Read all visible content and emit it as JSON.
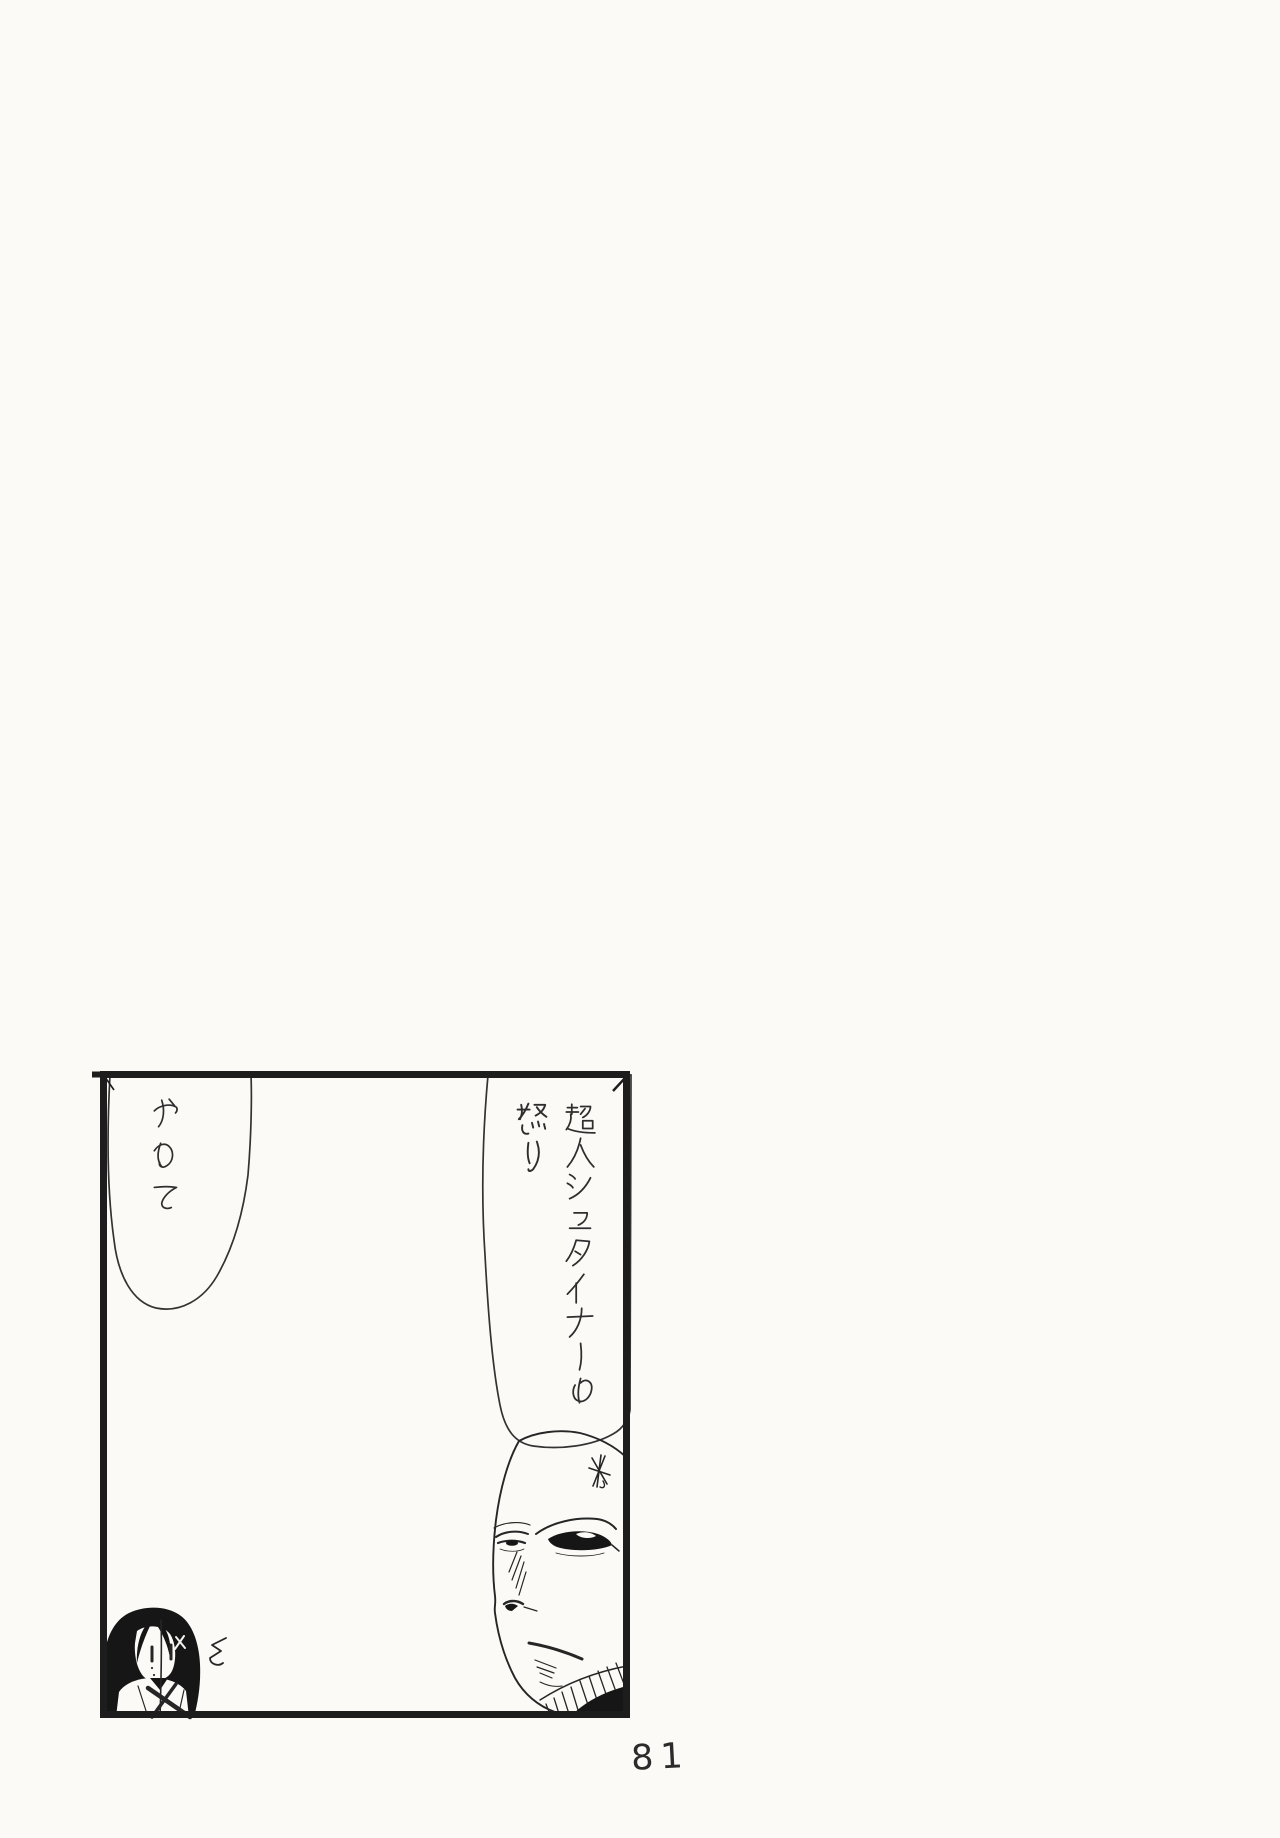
{
  "page": {
    "kind": "scanned manga page",
    "background_color": "#fbfaf7",
    "ink_color": "#1e1e1e",
    "page_number": "81"
  },
  "panel": {
    "speech_bubbles": [
      {
        "id": "bubble-left",
        "text": "やめて",
        "columns": [
          "やめて"
        ],
        "writing_direction": "vertical"
      },
      {
        "id": "bubble-right",
        "text": "超人シュタイナーの怒り",
        "columns": [
          "超人シュタイナーの",
          "怒り"
        ],
        "writing_direction": "vertical"
      }
    ],
    "characters": [
      {
        "id": "girl",
        "label": "long-haired girl"
      },
      {
        "id": "bald-man",
        "label": "bald stern man"
      }
    ],
    "marks": [
      {
        "id": "squiggle",
        "shape": "zigzag squiggle"
      },
      {
        "id": "anger-scribble",
        "shape": "hand-drawn asterisk"
      }
    ]
  }
}
